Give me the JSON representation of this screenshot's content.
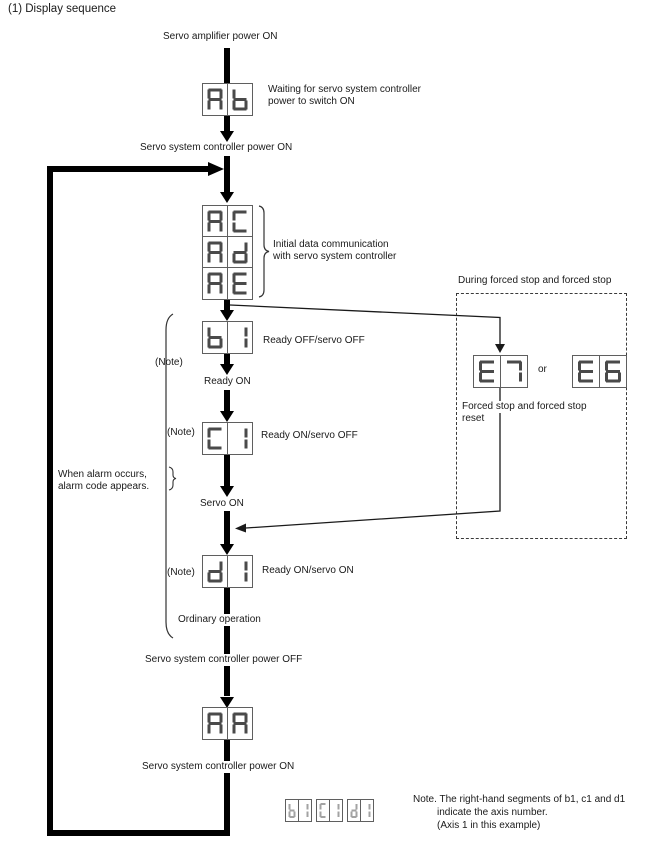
{
  "title": "(1) Display sequence",
  "colors": {
    "segment_main": "#4a4a4a",
    "segment_note": "#a3a3a3",
    "line": "#000000",
    "box_border": "#5f5f5f"
  },
  "flow": {
    "servo_amp_power_on": "Servo amplifier power ON",
    "waiting_line1": "Waiting for servo system controller",
    "waiting_line2": "power to switch ON",
    "controller_power_on": "Servo system controller power ON",
    "initial_line1": "Initial data communication",
    "initial_line2": "with servo system controller",
    "ready_off_servo_off": "Ready OFF/servo OFF",
    "note_label": "(Note)",
    "ready_on": "Ready ON",
    "ready_on_servo_off": "Ready ON/servo OFF",
    "alarm_line1": "When alarm occurs,",
    "alarm_line2": "alarm code appears.",
    "servo_on": "Servo ON",
    "ready_on_servo_on": "Ready ON/servo ON",
    "ordinary_operation": "Ordinary operation",
    "controller_power_off": "Servo system controller power OFF",
    "controller_power_on_bottom": "Servo system controller power ON"
  },
  "forced_stop": {
    "title": "During forced stop and forced stop",
    "or_label": "or",
    "caption_line1": "Forced stop and forced stop",
    "caption_line2": "reset"
  },
  "displays": {
    "ab": "Ab",
    "ac": "AC",
    "ad": "Ad",
    "ae": "AE",
    "b1": "b1",
    "c1": "C1",
    "d1": "d1",
    "e7": "E7",
    "e6": "E6",
    "aa": "AA",
    "note_b1": "b1",
    "note_c1": "C1",
    "note_d1": "d1"
  },
  "note": {
    "line1": "Note. The right-hand segments of b1, c1 and d1",
    "line2": "indicate the axis number.",
    "line3": "(Axis 1 in this example)"
  }
}
